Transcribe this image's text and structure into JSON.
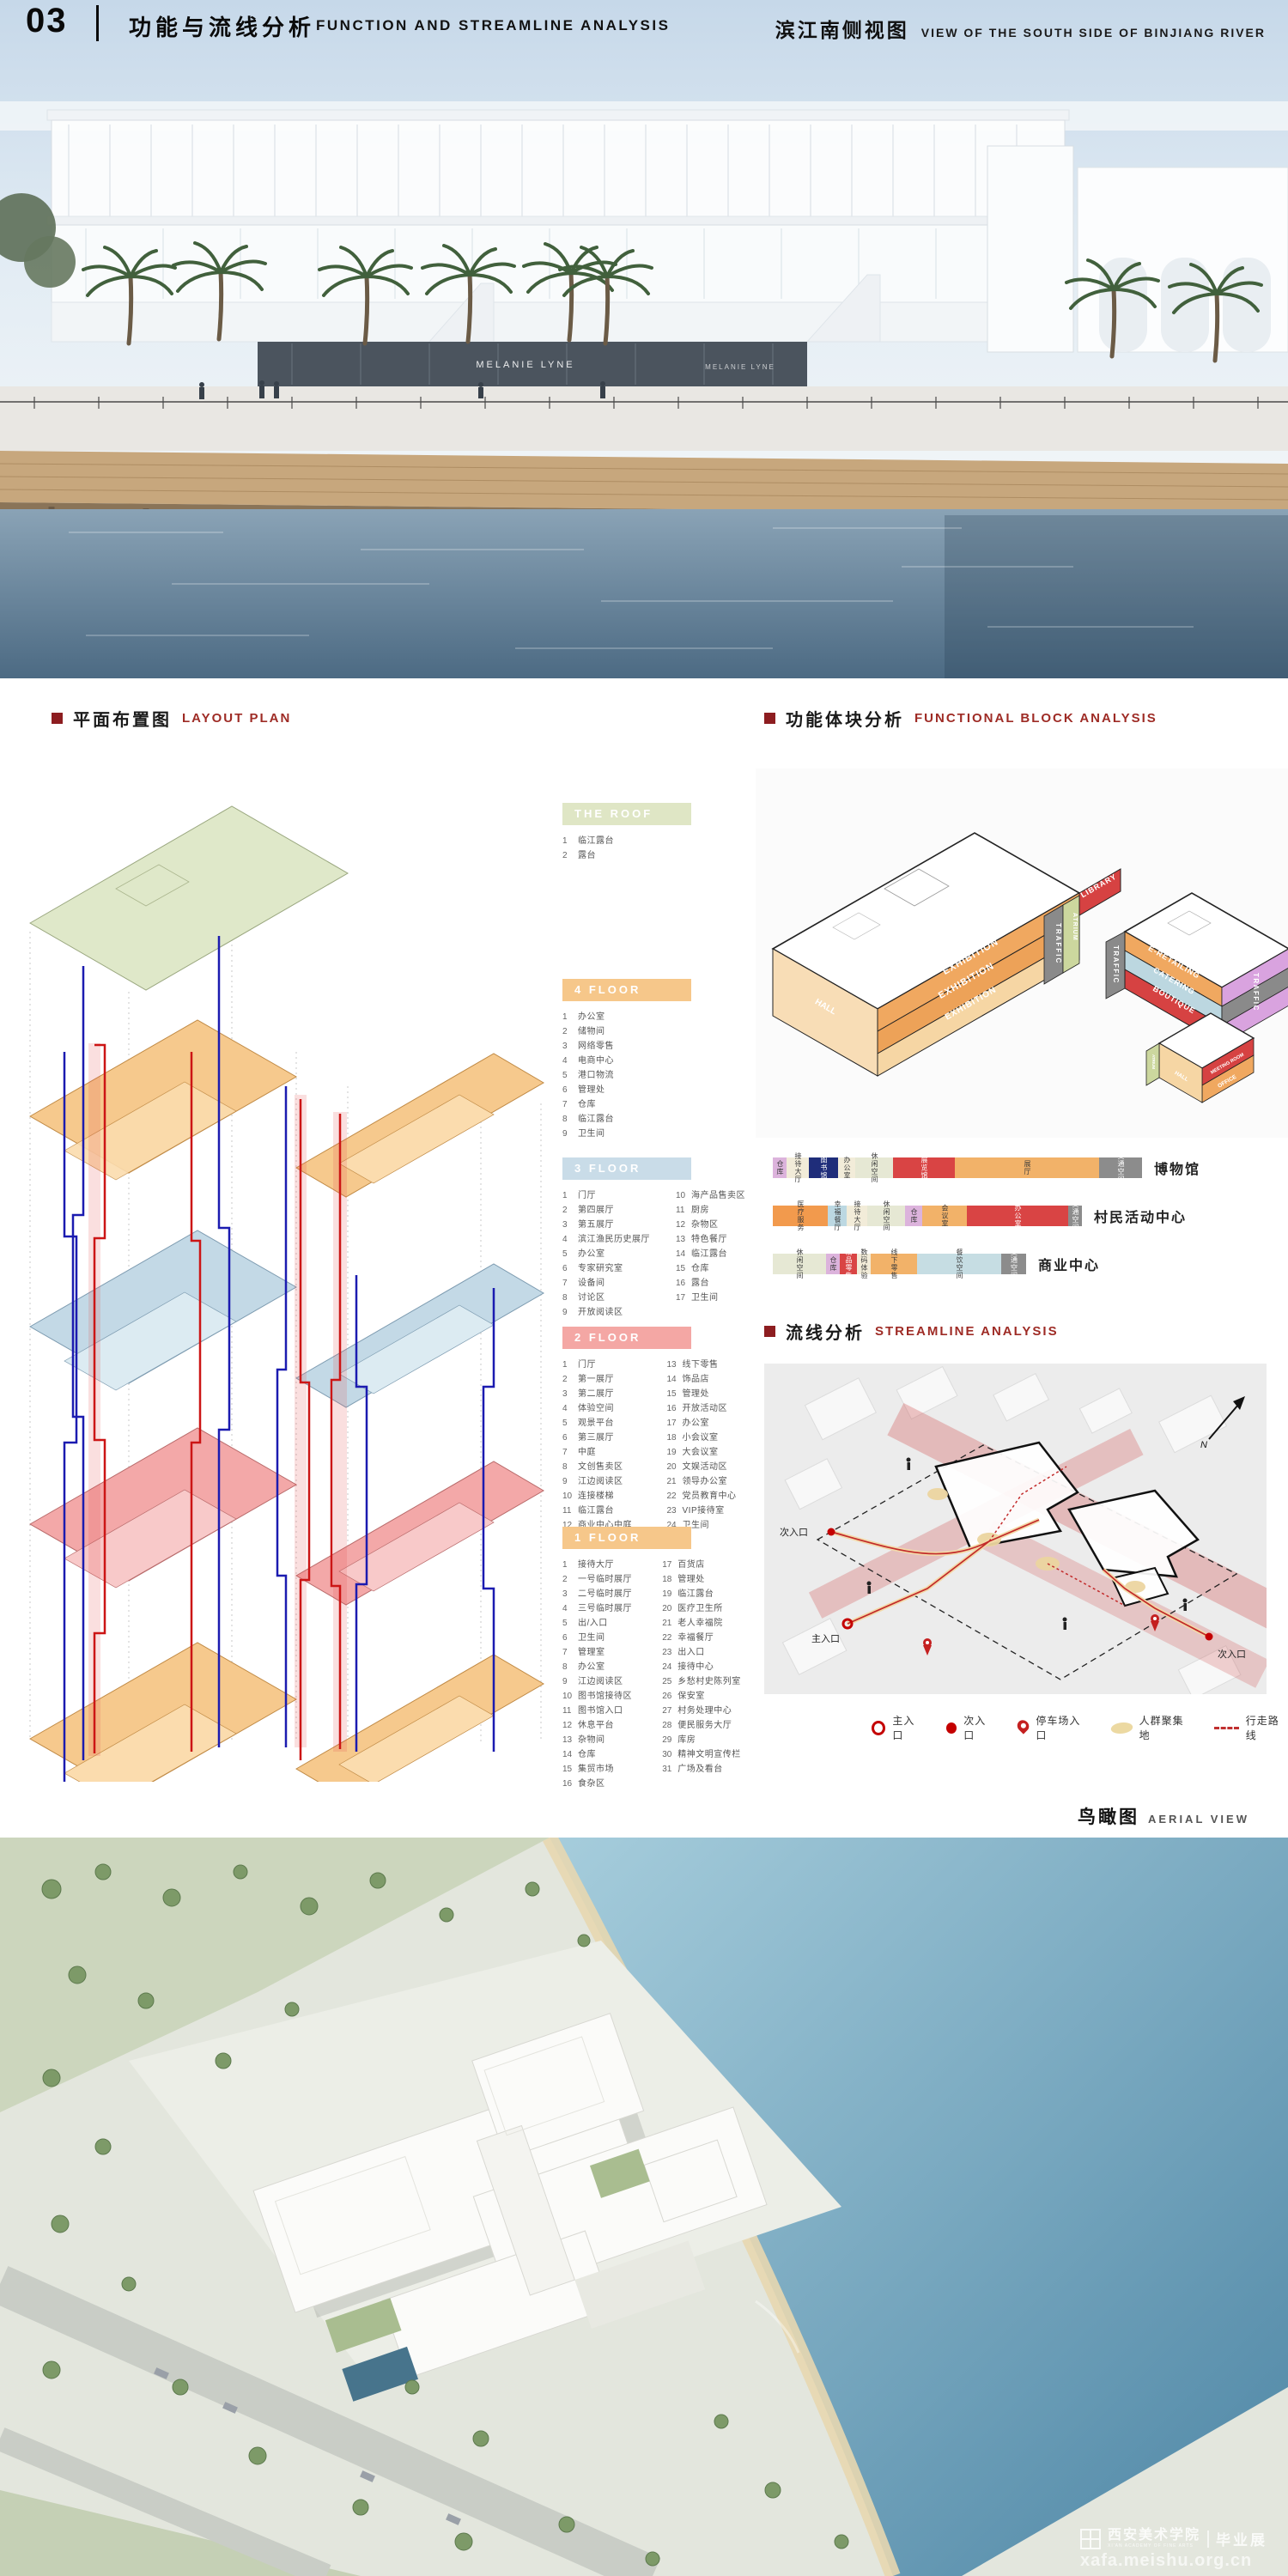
{
  "header": {
    "page_number": "03",
    "title_cn": "功能与流线分析",
    "title_en": "FUNCTION AND STREAMLINE ANALYSIS",
    "right_cn": "滨江南侧视图",
    "right_en": "VIEW OF THE SOUTH SIDE OF BINJIANG RIVER"
  },
  "sections": {
    "layout_plan": {
      "cn": "平面布置图",
      "en": "LAYOUT PLAN"
    },
    "functional_block": {
      "cn": "功能体块分析",
      "en": "FUNCTIONAL BLOCK ANALYSIS"
    },
    "streamline": {
      "cn": "流线分析",
      "en": "STREAMLINE ANALYSIS"
    },
    "aerial": {
      "cn": "鸟瞰图",
      "en": "AERIAL VIEW"
    }
  },
  "render_top": {
    "storefront_sign": "MELANIE LYNE"
  },
  "floors": [
    {
      "name": "THE ROOF",
      "color": "#dfe6c5",
      "cols": 1,
      "rows": 2,
      "items": [
        "临江露台",
        "露台"
      ]
    },
    {
      "name": "4 FLOOR",
      "color": "#f6c78a",
      "cols": 1,
      "rows": 9,
      "items": [
        "办公室",
        "储物间",
        "网络零售",
        "电商中心",
        "港口物流",
        "管理处",
        "仓库",
        "临江露台",
        "卫生间"
      ]
    },
    {
      "name": "3 FLOOR",
      "color": "#c9dce8",
      "cols": 2,
      "rows": 9,
      "items": [
        "门厅",
        "第四展厅",
        "第五展厅",
        "滨江渔民历史展厅",
        "办公室",
        "专家研究室",
        "设备间",
        "讨论区",
        "开放阅读区",
        "海产品售卖区",
        "厨房",
        "杂物区",
        "特色餐厅",
        "临江露台",
        "仓库",
        "露台",
        "卫生间"
      ]
    },
    {
      "name": "2 FLOOR",
      "color": "#f4a7a4",
      "cols": 2,
      "rows": 12,
      "items": [
        "门厅",
        "第一展厅",
        "第二展厅",
        "体验空间",
        "观景平台",
        "第三展厅",
        "中庭",
        "文创售卖区",
        "江边阅读区",
        "连接楼梯",
        "临江露台",
        "商业中心中庭",
        "线下零售",
        "饰品店",
        "管理处",
        "开放活动区",
        "办公室",
        "小会议室",
        "大会议室",
        "文娱活动区",
        "领导办公室",
        "党员教育中心",
        "VIP接待室",
        "卫生间"
      ]
    },
    {
      "name": "1 FLOOR",
      "color": "#f6c78a",
      "cols": 2,
      "rows": 16,
      "items": [
        "接待大厅",
        "一号临时展厅",
        "二号临时展厅",
        "三号临时展厅",
        "出/入口",
        "卫生间",
        "管理室",
        "办公室",
        "江边阅读区",
        "图书馆接待区",
        "图书馆入口",
        "休息平台",
        "杂物间",
        "仓库",
        "集贸市场",
        "食杂区",
        "百货店",
        "管理处",
        "临江露台",
        "医疗卫生所",
        "老人幸福院",
        "幸福餐厅",
        "出入口",
        "接待中心",
        "乡愁村史陈列室",
        "保安室",
        "村务处理中心",
        "便民服务大厅",
        "库房",
        "精神文明宣传栏",
        "广场及看台"
      ]
    }
  ],
  "block_diagram": {
    "exhibition_1": "EXHIBITION",
    "exhibition_2": "EXHIBITION",
    "exhibition_3": "EXHIBITION",
    "hall": "HALL",
    "traffic_left": "TRAFFIC",
    "atrium_left": "ATRIUM",
    "library": "LIBRARY",
    "traffic_mid": "TRAFFIC",
    "e_retailing": "E-RETAILING",
    "catering": "CATERING",
    "boutique": "BOUTIQUE",
    "traffic_right": "TRAFFIC",
    "meeting_room": "MEETING ROOM",
    "office": "OFFICE",
    "hall_small": "HALL",
    "atrium_small": "ATRIUM"
  },
  "function_bars": [
    {
      "label": "博物馆",
      "segments": [
        {
          "t": "仓库",
          "w": 16,
          "c": "#dcb3dc"
        },
        {
          "t": "接待大厅",
          "w": 26,
          "c": "#f2ecd9"
        },
        {
          "t": "图书馆",
          "w": 34,
          "c": "#1f2d7a",
          "light": true
        },
        {
          "t": "办公室",
          "w": 20,
          "c": "#f2ecd9"
        },
        {
          "t": "休闲空间",
          "w": 44,
          "c": "#e6e8d4"
        },
        {
          "t": "展览馆",
          "w": 72,
          "c": "#d94444",
          "light": true
        },
        {
          "t": "展厅",
          "w": 168,
          "c": "#f2b269"
        },
        {
          "t": "交通空间",
          "w": 50,
          "c": "#8c8c8c",
          "light": true
        }
      ]
    },
    {
      "label": "村民活动中心",
      "segments": [
        {
          "t": "医疗服务",
          "w": 64,
          "c": "#f29a4d"
        },
        {
          "t": "幸福餐厅",
          "w": 22,
          "c": "#bcd8e2"
        },
        {
          "t": "接待大厅",
          "w": 24,
          "c": "#f2ecd9"
        },
        {
          "t": "休闲空间",
          "w": 44,
          "c": "#e6e8d4"
        },
        {
          "t": "仓库",
          "w": 20,
          "c": "#dcb3dc"
        },
        {
          "t": "会议室",
          "w": 52,
          "c": "#f2b269"
        },
        {
          "t": "办公室",
          "w": 118,
          "c": "#d94444",
          "light": true
        },
        {
          "t": "交通空间",
          "w": 16,
          "c": "#8c8c8c",
          "light": true
        }
      ]
    },
    {
      "label": "商业中心",
      "segments": [
        {
          "t": "休闲空间",
          "w": 62,
          "c": "#e6e8d4"
        },
        {
          "t": "仓库",
          "w": 16,
          "c": "#dcb3dc"
        },
        {
          "t": "精品零售",
          "w": 20,
          "c": "#d94444",
          "light": true
        },
        {
          "t": "数码体验",
          "w": 16,
          "c": "#f2ecd9"
        },
        {
          "t": "线下零售",
          "w": 54,
          "c": "#f2b269"
        },
        {
          "t": "餐饮空间",
          "w": 98,
          "c": "#c6dde3"
        },
        {
          "t": "交通空间",
          "w": 29,
          "c": "#8c8c8c",
          "light": true
        }
      ]
    }
  ],
  "streamline_diagram": {
    "entrance_left": "次入口",
    "entrance_main": "主入口",
    "entrance_right": "次入口",
    "north": "N"
  },
  "streamline_legend": [
    {
      "icon": "main-entrance-icon",
      "cls": "ic-ring",
      "label": "主入口"
    },
    {
      "icon": "secondary-entrance-icon",
      "cls": "ic-dot",
      "label": "次入口"
    },
    {
      "icon": "parking-entrance-icon",
      "cls": "ic-pin",
      "label": "停车场入口"
    },
    {
      "icon": "crowd-area-icon",
      "cls": "ic-blob",
      "label": "人群聚集地"
    },
    {
      "icon": "walking-route-icon",
      "cls": "ic-route",
      "label": "行走路线"
    }
  ],
  "watermark": {
    "school": "西安美术学院",
    "school_en": "XI'AN ACADEMY OF FINE ARTS",
    "exhibition": "毕业展",
    "url": "xafa.meishu.org.cn"
  }
}
